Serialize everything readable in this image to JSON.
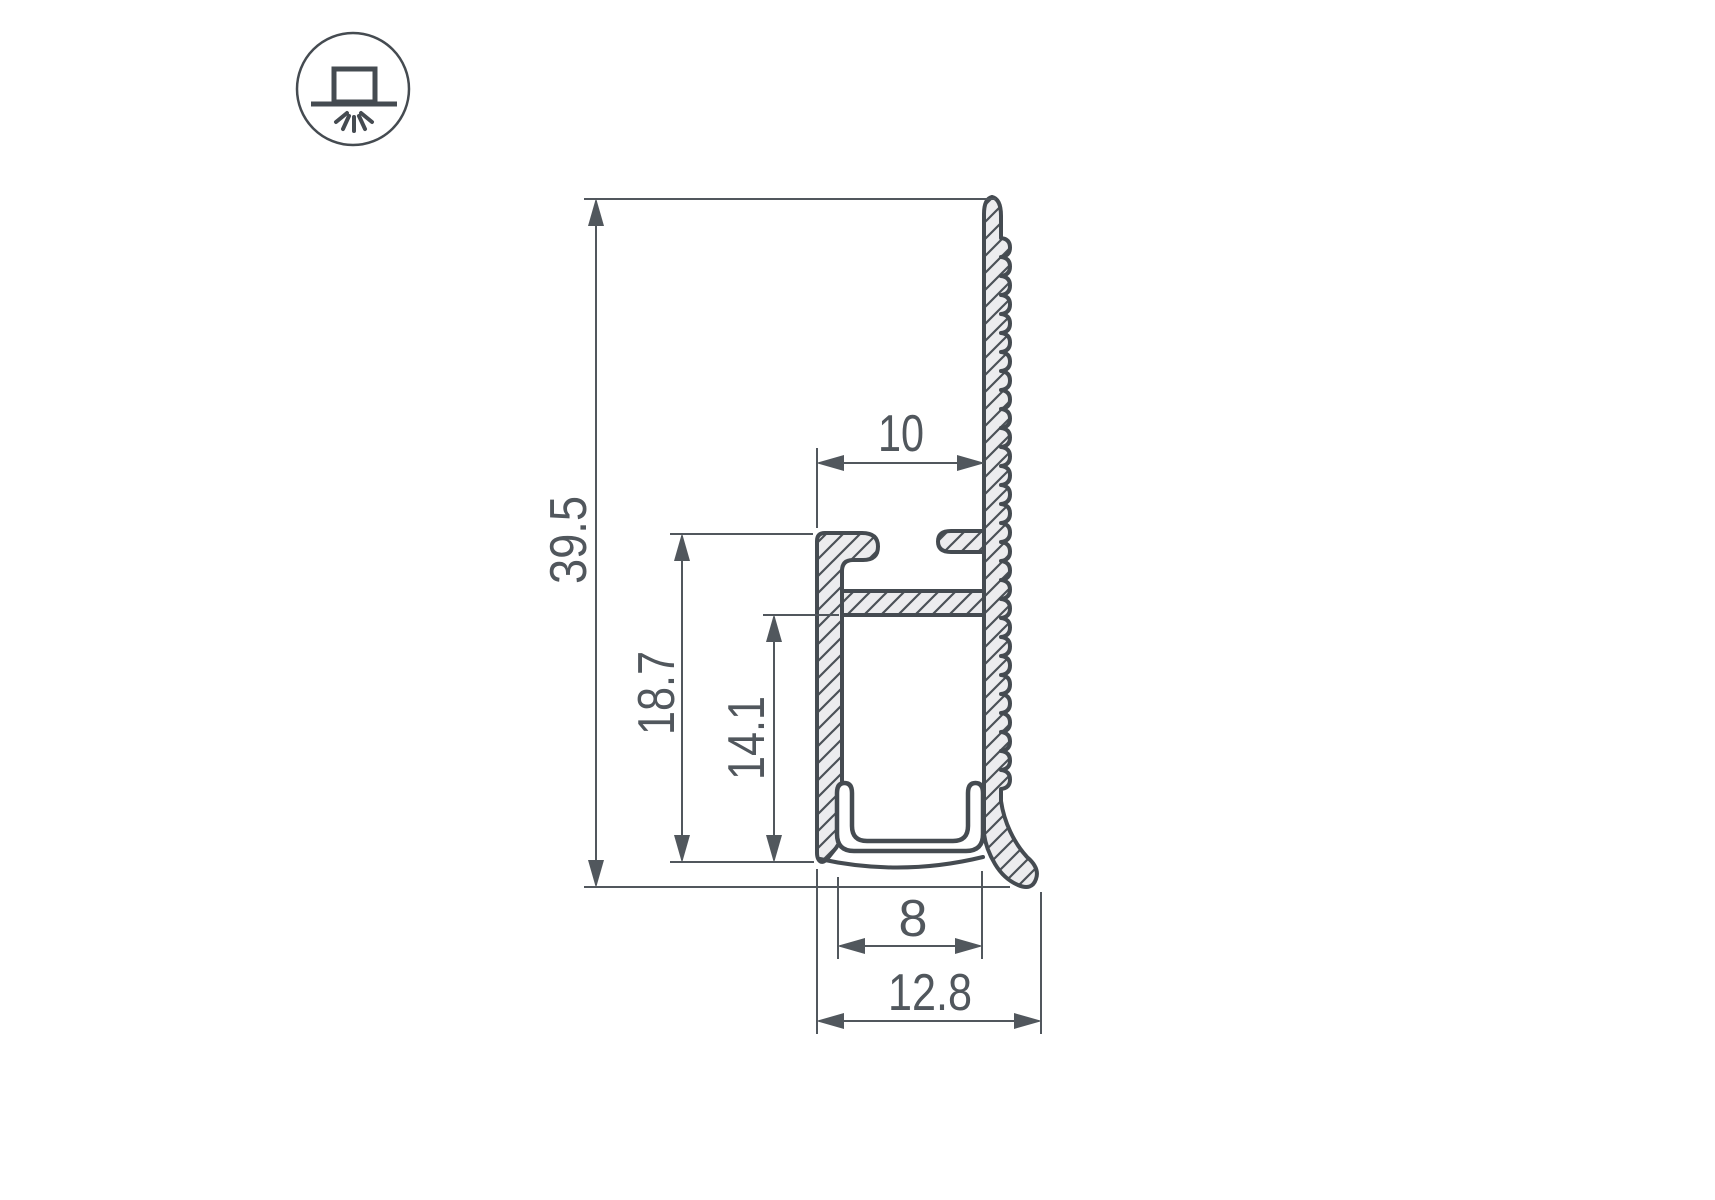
{
  "drawing": {
    "background": "#ffffff",
    "outline_color": "#454b51",
    "metal_fill_color": "#ececee",
    "dimension_color": "#51575d"
  },
  "icon": {
    "name": "surface-mounted-luminaire-symbol"
  },
  "dimensions": {
    "overall_height": "39.5",
    "body_height": "18.7",
    "channel_depth": "14.1",
    "top_width": "10",
    "channel_width": "8",
    "overall_width": "12.8"
  }
}
